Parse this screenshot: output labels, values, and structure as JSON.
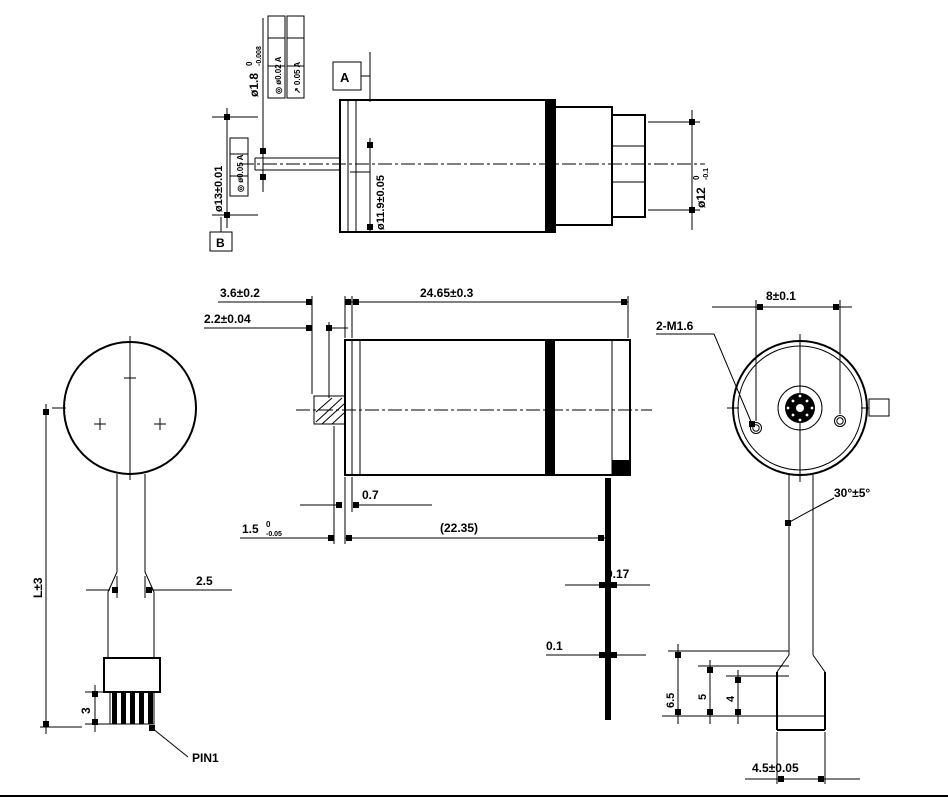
{
  "colors": {
    "ink": "#000000",
    "paper": "#ffffff"
  },
  "views": {
    "top_side_view": {
      "shaft_dia_value": "ø1.8",
      "shaft_dia_tol_upper": "0",
      "shaft_dia_tol_lower": "-0.008",
      "fcf_frame_1": "◎ ø0.02 A",
      "fcf_frame_2": "↗ 0.05 A",
      "datum_a": "A",
      "datum_b": "B",
      "bearing_dia": "ø13±0.01",
      "bearing_fcf": "◎ ø0.05 A",
      "body_dia": "ø11.9±0.05",
      "rear_dia_value": "ø12",
      "rear_dia_tol_upper": "0",
      "rear_dia_tol_lower": "-0.1"
    },
    "front_view": {
      "cable_length": "L±3",
      "cable_width": "2.5",
      "pin_length": "3",
      "pin_label": "PIN1"
    },
    "side_view": {
      "pinion_offset": "3.6±0.2",
      "pinion_width": "2.2±0.04",
      "body_length": "24.65±0.3",
      "flange_thickness": "0.7",
      "shaft_length_value": "1.5",
      "shaft_length_tol_upper": "0",
      "shaft_length_tol_lower": "-0.05",
      "ref_length": "(22.35)",
      "terminal_thickness": "0.17",
      "terminal_tip_thickness": "0.1"
    },
    "rear_view": {
      "hole_spacing": "8±0.1",
      "screw_callout": "2-M1.6",
      "angle": "30°±5°",
      "step_1": "6.5",
      "step_2": "5",
      "step_3": "4",
      "tab_width": "4.5±0.05"
    }
  }
}
